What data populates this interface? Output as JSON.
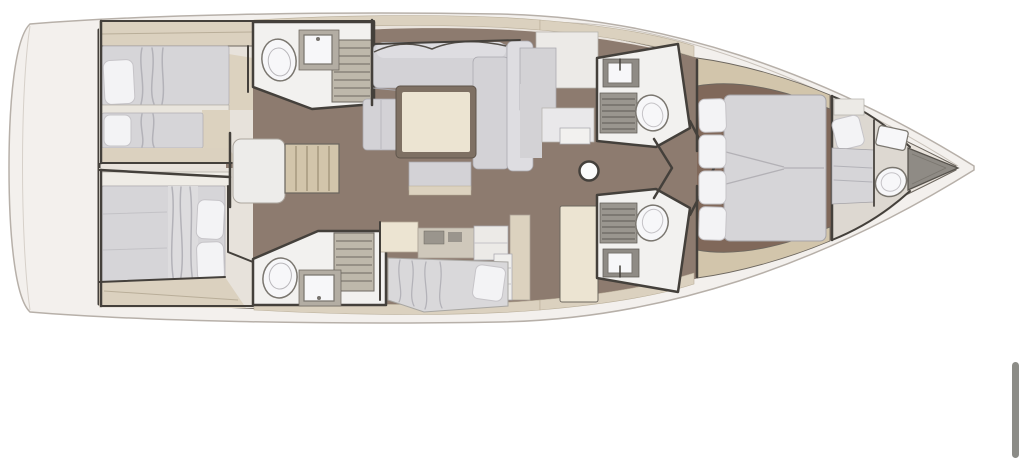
{
  "document": {
    "kind": "yacht-interior-floor-plan",
    "orientation": "bow-right",
    "visible_text": ""
  },
  "rooms": {
    "swim_platform": "swim-platform",
    "aft_cabin_port": "aft-cabin-port",
    "aft_cabin_starboard": "aft-cabin-starboard",
    "aft_head_port": "aft-head-port",
    "aft_head_starboard": "aft-head-starboard",
    "companionway": "companionway-stairs",
    "salon": "salon",
    "nav_station": "nav-station",
    "galley": "galley",
    "forward_head_port": "forward-head-port",
    "forward_head_starboard": "forward-head-starboard",
    "owner_cabin": "owner-cabin",
    "crew_cabin": "crew-cabin",
    "bow_locker": "bow-locker",
    "mast": "mast"
  },
  "palette": {
    "page_bg": "#ffffff",
    "hull_fill": "#f3f0ed",
    "hull_stroke": "#b7b0a9",
    "deck": "#e9e3dc",
    "teak": "#dbd1bf",
    "teak_dark": "#d2c5ab",
    "wall": "#44403b",
    "wall_light": "#6d675f",
    "wood_floor": "#8d7b6f",
    "wood_floor_dark": "#80685a",
    "cabin_bg": "#e7e2db",
    "floor_white": "#f2f1ef",
    "floor_crew": "#ddd8d1",
    "mattress": "#d6d5d8",
    "mattress_line": "#b3b2b8",
    "pillow": "#f3f3f5",
    "pillow_stroke": "#c6c4c8",
    "cushion": "#d3d2d6",
    "cushion_hi": "#dedde1",
    "cream": "#ece4d2",
    "cream_dark": "#dcd2bf",
    "white_unit": "#eceae7",
    "gray_unit": "#d3d2d5",
    "grate": "#beb8ab",
    "grate_line": "#6e6962",
    "grate_fwd": "#9a968f",
    "fixture": "#f7f7f9",
    "fixture_stroke": "#7a766f",
    "dark_unit": "#9a958d",
    "locker": "#8f8b85",
    "scrollbar": "#8c8c87"
  },
  "ui": {
    "scrollbar": {
      "x": 1012,
      "y": 362,
      "width": 7,
      "height": 96
    }
  }
}
